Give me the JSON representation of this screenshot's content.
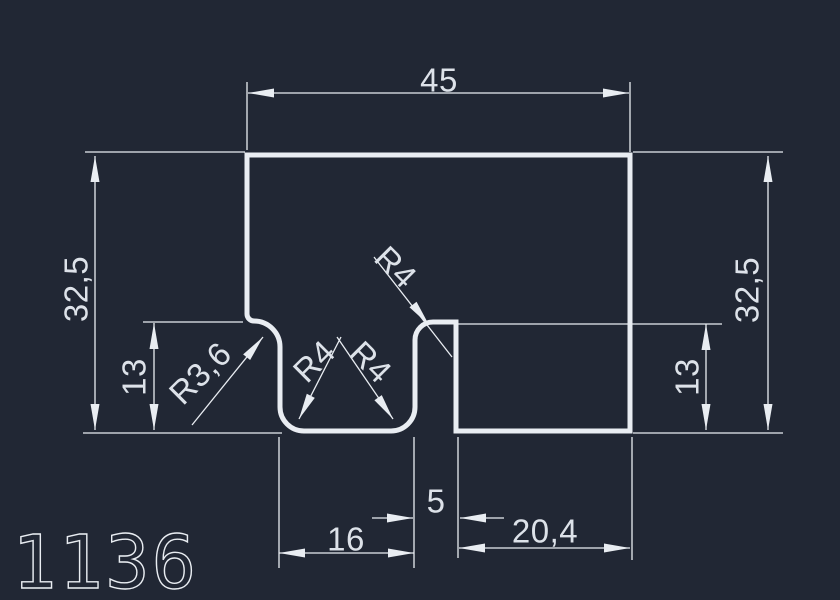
{
  "drawing": {
    "part_number": "1136",
    "colors": {
      "background": "#212734",
      "line": "#e9edf2",
      "text": "#dde2e9"
    },
    "dimensions": [
      {
        "id": "top_width",
        "label": "45",
        "value": 45
      },
      {
        "id": "left_height",
        "label": "32,5",
        "value": 32.5
      },
      {
        "id": "left_step_height",
        "label": "13",
        "value": 13
      },
      {
        "id": "right_height",
        "label": "32,5",
        "value": 32.5
      },
      {
        "id": "right_step_height",
        "label": "13",
        "value": 13
      },
      {
        "id": "groove_width",
        "label": "16",
        "value": 16
      },
      {
        "id": "slot_width",
        "label": "5",
        "value": 5
      },
      {
        "id": "bottom_right_width",
        "label": "20,4",
        "value": 20.4
      }
    ],
    "radii": [
      {
        "id": "left_fillet",
        "label": "R3,6",
        "value": 3.6
      },
      {
        "id": "groove_bottom_left",
        "label": "R4",
        "value": 4
      },
      {
        "id": "groove_bottom_right",
        "label": "R4",
        "value": 4
      },
      {
        "id": "slot_top_fillet",
        "label": "R4",
        "value": 4
      }
    ]
  }
}
